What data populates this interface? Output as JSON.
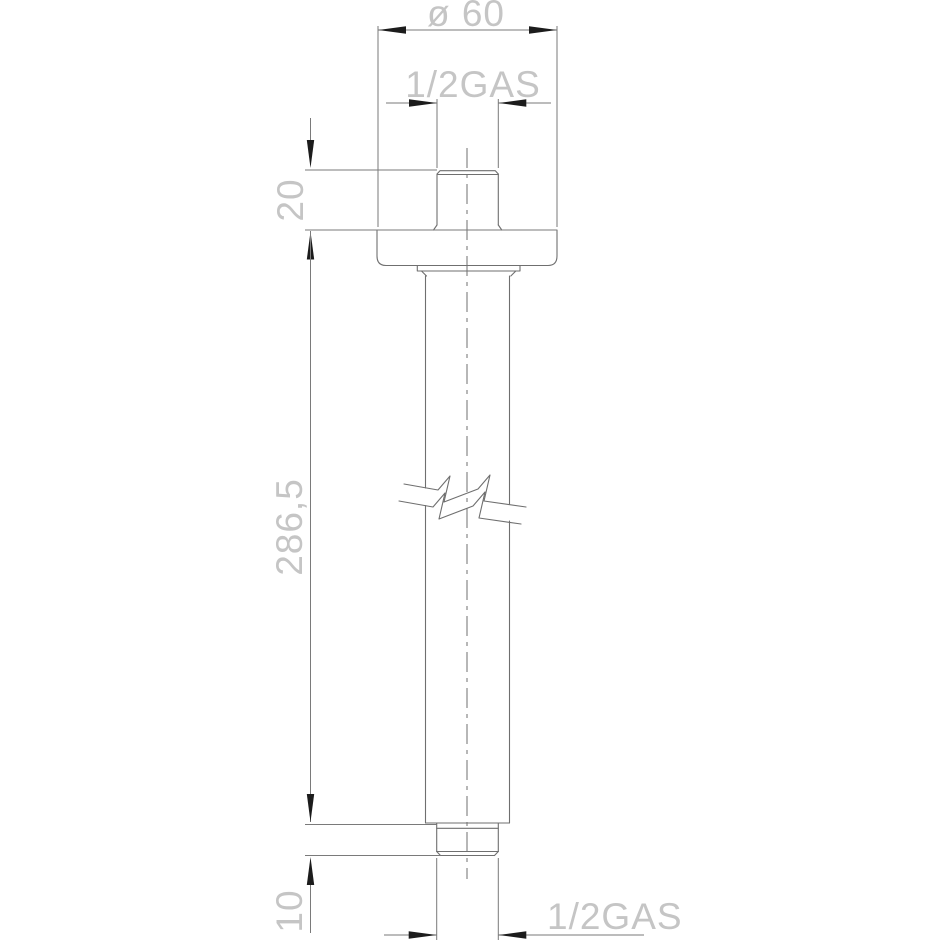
{
  "drawing": {
    "type": "technical-dimension-drawing",
    "part": "ceiling-mounted shower arm, side view"
  },
  "dimensions": {
    "flange_diameter": {
      "label": "ø 60"
    },
    "top_thread": {
      "label": "1/2GAS"
    },
    "flange_offset": {
      "label": "20"
    },
    "arm_length": {
      "label": "286,5"
    },
    "bottom_thread_length": {
      "label": "10"
    },
    "bottom_thread": {
      "label": "1/2GAS"
    }
  },
  "colors": {
    "background": "#ffffff",
    "line": "#6f6f6f",
    "dim_line": "#7a7a7a",
    "arrow": "#1c1c1c",
    "text": "#c5c5c5"
  }
}
